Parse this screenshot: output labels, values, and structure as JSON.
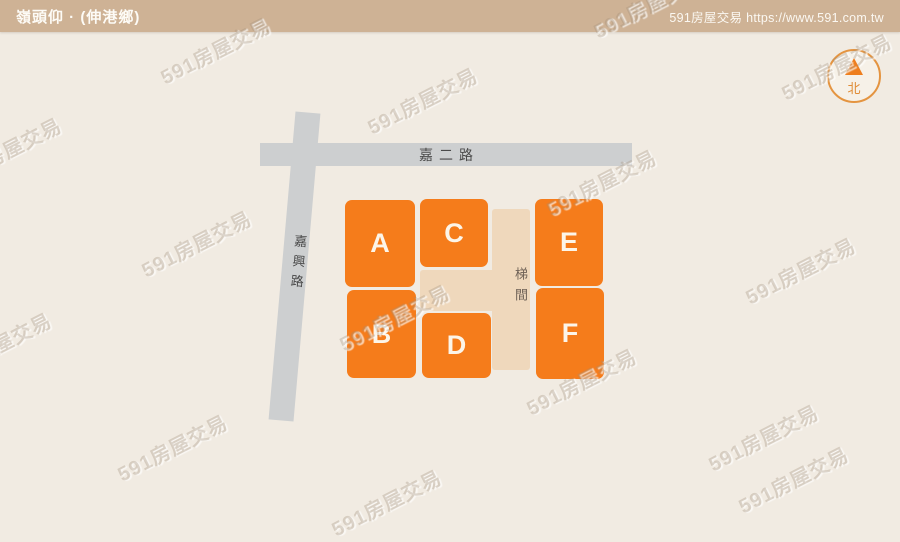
{
  "header": {
    "title": "嶺頭仰 · (伸港鄉)",
    "site_label": "591房屋交易 https://www.591.com.tw"
  },
  "map": {
    "road_horizontal": "嘉二路",
    "road_vertical": "嘉興路",
    "stairwell_label": "梯間",
    "buildings": [
      {
        "label": "A"
      },
      {
        "label": "B"
      },
      {
        "label": "C"
      },
      {
        "label": "D"
      },
      {
        "label": "E"
      },
      {
        "label": "F"
      }
    ],
    "compass_north": "北"
  },
  "watermark_text": "591房屋交易",
  "colors": {
    "building_orange": "#F57C1B",
    "header_tan": "#CEB295",
    "road_gray": "#CDCFD0",
    "stairwell_beige": "#EFD8BC",
    "background_cream": "#F1EBE2",
    "compass_orange": "#E49440"
  }
}
